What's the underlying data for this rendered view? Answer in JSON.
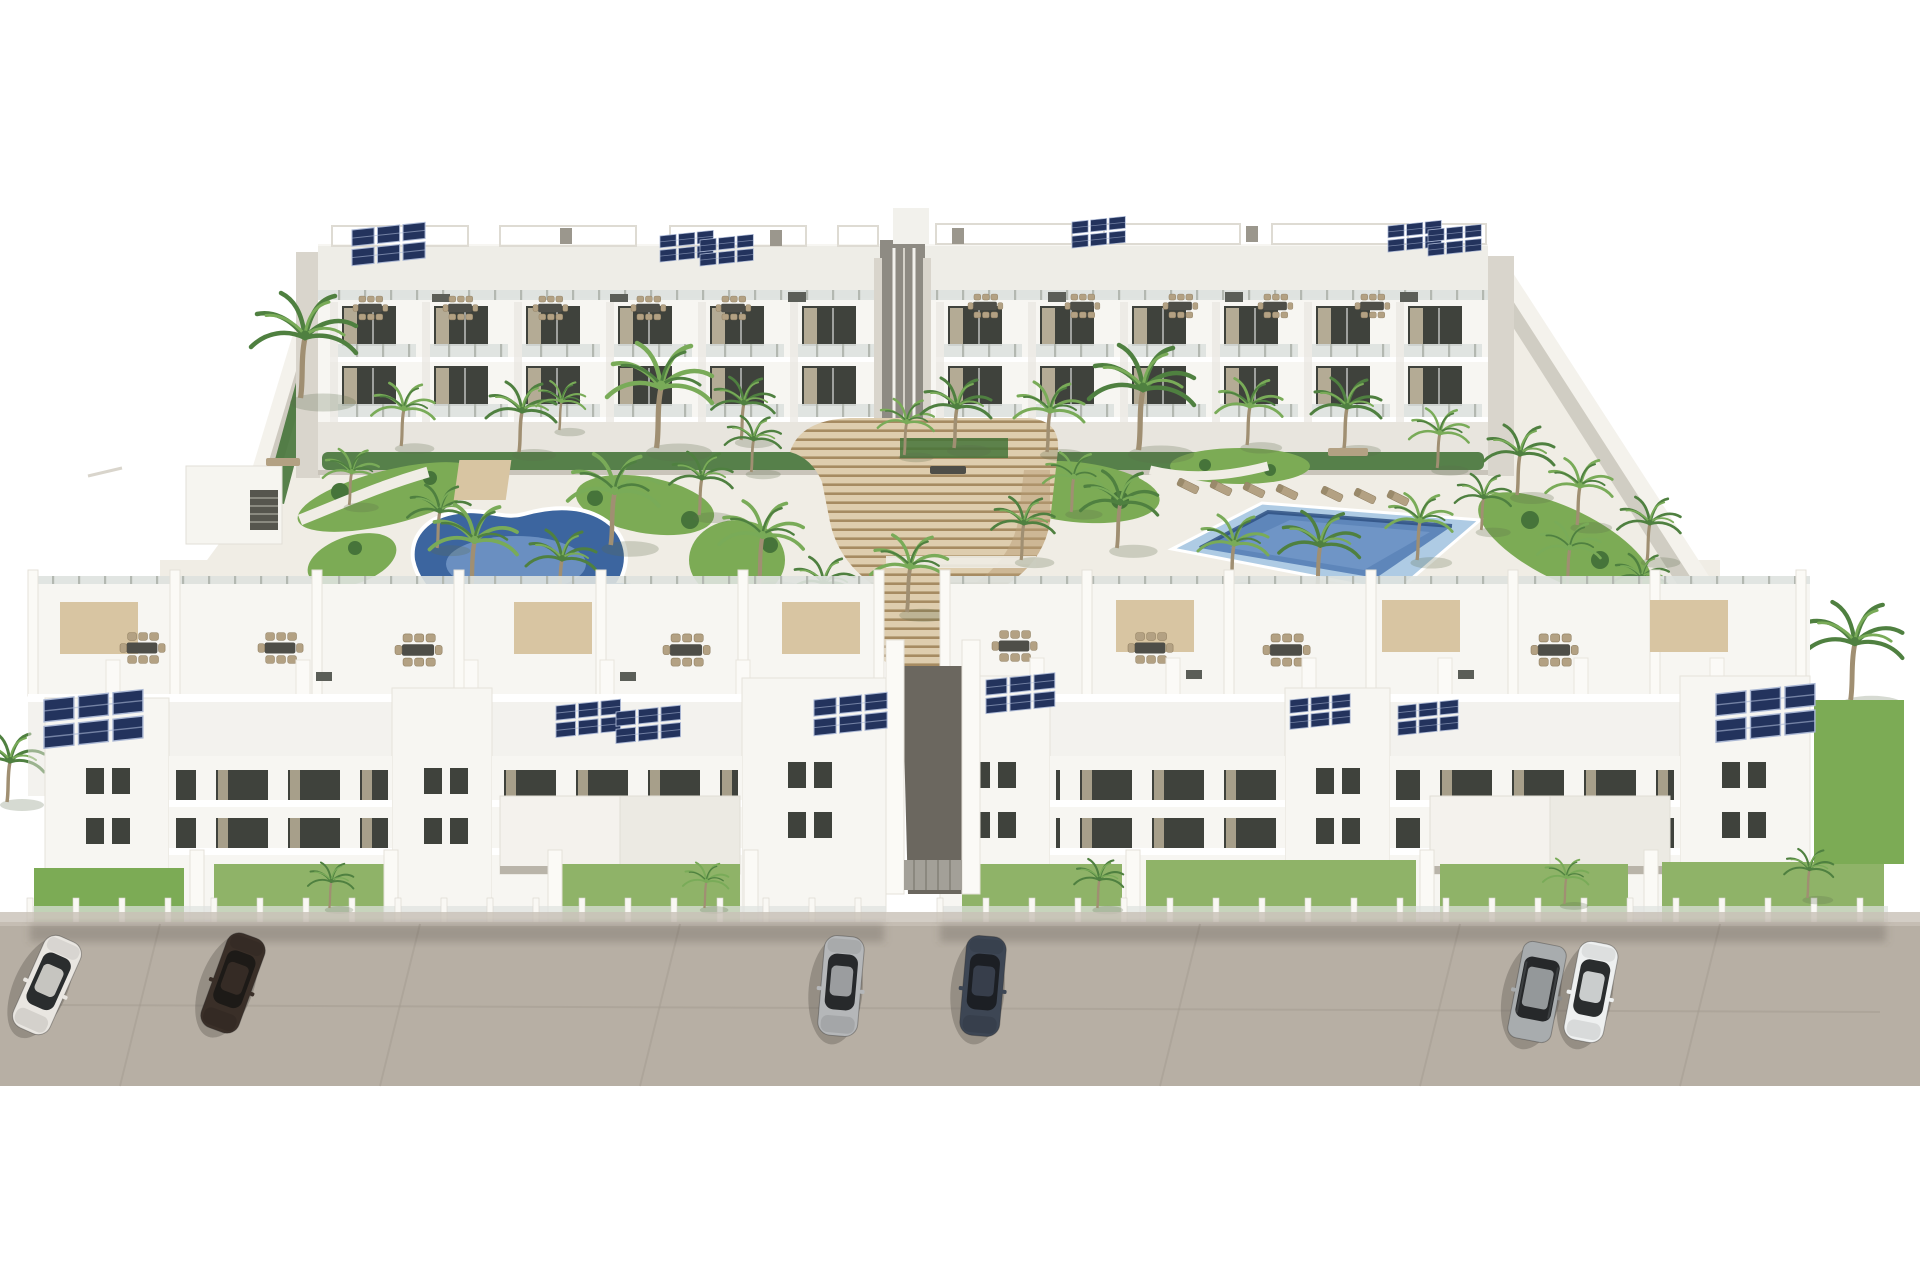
{
  "scene": {
    "kind": "aerial architectural render",
    "subject": "new-build white residential apartment complex with two communal pools, landscaped garden, central amphitheater staircase, rooftop solar panels and street parking",
    "sky": "plain white background",
    "time_of_day": "bright daylight"
  },
  "palette": {
    "building_white": "#f7f6f2",
    "building_shade": "#e8e5de",
    "building_side": "#d9d5cc",
    "deck_white": "#f0ede5",
    "wall_gray": "#c6c1b7",
    "window_dark": "#3f423c",
    "curtain": "#c9bda4",
    "rail_glass": "#dee3df",
    "rail_post": "#b3b8b1",
    "solar": "#23335d",
    "solar_line": "#aab7d4",
    "pergola_tan": "#d8c5a2",
    "pergola_line": "#dedbd3",
    "furn_tan": "#b3a183",
    "furn_dark": "#4e4e48",
    "stair_tread": "#decdae",
    "stair_riser": "#a68b62",
    "stair_side": "#b99d78",
    "grass_green": "#7cab55",
    "grass_bright": "#8fb368",
    "shrub_green": "#46743a",
    "palm_dark": "#4f8040",
    "palm_light": "#79ab58",
    "trunk": "#a08f72",
    "pool_ring": "#3c659f",
    "pool_water": "#5b8ac8",
    "pool_light": "#8fb2dc",
    "rpool_outer": "#aecbe4",
    "rpool_water": "#5e86ba",
    "rpool_edge": "#2f5183",
    "road_gray": "#b7afa4",
    "road_seam": "#a29a8f",
    "sidewalk": "#c8c1b6",
    "walk_dark": "#6b675f",
    "shadow": "#55504a"
  },
  "buildings": {
    "back_left": {
      "label": "rear apartment block west",
      "bays": {
        "start": 330,
        "count": 6,
        "step": 92,
        "rows": [
          302,
          362
        ]
      }
    },
    "back_right": {
      "label": "rear apartment block east",
      "bays": {
        "start": 936,
        "count": 6,
        "step": 92,
        "rows": [
          302,
          362
        ]
      }
    },
    "front_left": {
      "label": "street-front block west"
    },
    "front_right": {
      "label": "street-front block east"
    }
  },
  "objects": {
    "solar_arrays": [
      {
        "x": 352,
        "y": 230,
        "s": 0.85
      },
      {
        "x": 660,
        "y": 236,
        "s": 0.62
      },
      {
        "x": 700,
        "y": 240,
        "s": 0.62
      },
      {
        "x": 1072,
        "y": 222,
        "s": 0.62
      },
      {
        "x": 1388,
        "y": 226,
        "s": 0.62
      },
      {
        "x": 1428,
        "y": 230,
        "s": 0.62
      },
      {
        "x": 44,
        "y": 700,
        "s": 1.15
      },
      {
        "x": 556,
        "y": 706,
        "s": 0.75
      },
      {
        "x": 616,
        "y": 712,
        "s": 0.75
      },
      {
        "x": 814,
        "y": 700,
        "s": 0.85
      },
      {
        "x": 986,
        "y": 680,
        "s": 0.8
      },
      {
        "x": 1290,
        "y": 700,
        "s": 0.7
      },
      {
        "x": 1398,
        "y": 706,
        "s": 0.7
      },
      {
        "x": 1716,
        "y": 694,
        "s": 1.15
      }
    ],
    "roof_dining": [
      {
        "x": 370,
        "y": 308,
        "s": 0.85
      },
      {
        "x": 460,
        "y": 308,
        "s": 0.85
      },
      {
        "x": 550,
        "y": 308,
        "s": 0.85
      },
      {
        "x": 648,
        "y": 308,
        "s": 0.85
      },
      {
        "x": 733,
        "y": 308,
        "s": 0.85
      },
      {
        "x": 985,
        "y": 306,
        "s": 0.85
      },
      {
        "x": 1082,
        "y": 306,
        "s": 0.85
      },
      {
        "x": 1180,
        "y": 306,
        "s": 0.85
      },
      {
        "x": 1275,
        "y": 306,
        "s": 0.85
      },
      {
        "x": 1372,
        "y": 306,
        "s": 0.85
      }
    ],
    "terrace_dining": [
      {
        "x": 142,
        "y": 648,
        "s": 1.1
      },
      {
        "x": 280,
        "y": 648,
        "s": 1.1
      },
      {
        "x": 418,
        "y": 650,
        "s": 1.15
      },
      {
        "x": 686,
        "y": 650,
        "s": 1.15
      },
      {
        "x": 1014,
        "y": 646,
        "s": 1.1
      },
      {
        "x": 1150,
        "y": 648,
        "s": 1.1
      },
      {
        "x": 1286,
        "y": 650,
        "s": 1.15
      },
      {
        "x": 1554,
        "y": 650,
        "s": 1.15
      }
    ],
    "canopies": [
      {
        "x": 514,
        "y": 602
      },
      {
        "x": 782,
        "y": 602
      },
      {
        "x": 60,
        "y": 602
      },
      {
        "x": 1382,
        "y": 600
      },
      {
        "x": 1650,
        "y": 600
      },
      {
        "x": 1116,
        "y": 600
      }
    ],
    "palms": [
      {
        "x": 302,
        "y": 398,
        "s": 1.5,
        "t": "d"
      },
      {
        "x": 402,
        "y": 446,
        "s": 0.9,
        "t": "l"
      },
      {
        "x": 520,
        "y": 452,
        "s": 1.0,
        "t": "d"
      },
      {
        "x": 560,
        "y": 430,
        "s": 0.7,
        "t": "l"
      },
      {
        "x": 658,
        "y": 448,
        "s": 1.5,
        "t": "l"
      },
      {
        "x": 742,
        "y": 440,
        "s": 0.9,
        "t": "d"
      },
      {
        "x": 905,
        "y": 455,
        "s": 0.8,
        "t": "l"
      },
      {
        "x": 955,
        "y": 448,
        "s": 1.0,
        "t": "d"
      },
      {
        "x": 1048,
        "y": 452,
        "s": 1.0,
        "t": "l"
      },
      {
        "x": 1140,
        "y": 450,
        "s": 1.5,
        "t": "d"
      },
      {
        "x": 1248,
        "y": 445,
        "s": 0.95,
        "t": "l"
      },
      {
        "x": 1345,
        "y": 448,
        "s": 1.0,
        "t": "d"
      },
      {
        "x": 1438,
        "y": 468,
        "s": 0.85,
        "t": "l"
      },
      {
        "x": 1518,
        "y": 495,
        "s": 1.0,
        "t": "d"
      },
      {
        "x": 1578,
        "y": 525,
        "s": 0.95,
        "t": "l"
      },
      {
        "x": 1648,
        "y": 560,
        "s": 0.9,
        "t": "d"
      },
      {
        "x": 350,
        "y": 505,
        "s": 0.8,
        "t": "l"
      },
      {
        "x": 438,
        "y": 548,
        "s": 0.9,
        "t": "d"
      },
      {
        "x": 472,
        "y": 592,
        "s": 1.25,
        "t": "l"
      },
      {
        "x": 560,
        "y": 600,
        "s": 1.0,
        "t": "d"
      },
      {
        "x": 612,
        "y": 545,
        "s": 1.3,
        "t": "l"
      },
      {
        "x": 700,
        "y": 515,
        "s": 0.9,
        "t": "d"
      },
      {
        "x": 760,
        "y": 585,
        "s": 1.2,
        "t": "l"
      },
      {
        "x": 752,
        "y": 472,
        "s": 0.8,
        "t": "d"
      },
      {
        "x": 822,
        "y": 620,
        "s": 0.9,
        "t": "d"
      },
      {
        "x": 908,
        "y": 612,
        "s": 1.1,
        "t": "l"
      },
      {
        "x": 1022,
        "y": 560,
        "s": 0.9,
        "t": "d"
      },
      {
        "x": 1072,
        "y": 512,
        "s": 0.85,
        "t": "l"
      },
      {
        "x": 1118,
        "y": 548,
        "s": 1.1,
        "t": "d"
      },
      {
        "x": 1232,
        "y": 585,
        "s": 1.0,
        "t": "l"
      },
      {
        "x": 1318,
        "y": 592,
        "s": 1.15,
        "t": "d"
      },
      {
        "x": 1418,
        "y": 560,
        "s": 0.95,
        "t": "l"
      },
      {
        "x": 1482,
        "y": 530,
        "s": 0.8,
        "t": "d"
      },
      {
        "x": 1568,
        "y": 585,
        "s": 0.9,
        "t": "l"
      },
      {
        "x": 1640,
        "y": 610,
        "s": 0.8,
        "t": "d"
      },
      {
        "x": 1852,
        "y": 700,
        "s": 1.4,
        "t": "d"
      },
      {
        "x": 330,
        "y": 908,
        "s": 0.65,
        "t": "d"
      },
      {
        "x": 705,
        "y": 908,
        "s": 0.65,
        "t": "l"
      },
      {
        "x": 1098,
        "y": 908,
        "s": 0.7,
        "t": "d"
      },
      {
        "x": 1565,
        "y": 904,
        "s": 0.65,
        "t": "l"
      },
      {
        "x": 1808,
        "y": 898,
        "s": 0.7,
        "t": "d"
      },
      {
        "x": 8,
        "y": 802,
        "s": 1.0,
        "t": "d"
      }
    ],
    "loungers": [
      {
        "x": 1188,
        "y": 486,
        "r": -64
      },
      {
        "x": 1221,
        "y": 488,
        "r": -64
      },
      {
        "x": 1254,
        "y": 490,
        "r": -64
      },
      {
        "x": 1287,
        "y": 492,
        "r": -64
      },
      {
        "x": 1332,
        "y": 494,
        "r": -64
      },
      {
        "x": 1365,
        "y": 496,
        "r": -64
      },
      {
        "x": 1398,
        "y": 498,
        "r": -64
      },
      {
        "x": 408,
        "y": 622,
        "r": -58
      },
      {
        "x": 444,
        "y": 630,
        "r": -58
      },
      {
        "x": 640,
        "y": 606,
        "r": -62
      },
      {
        "x": 674,
        "y": 600,
        "r": -62
      }
    ],
    "benches": [
      {
        "x": 948,
        "y": 470,
        "w": 36,
        "tone": "dark"
      },
      {
        "x": 1348,
        "y": 452,
        "w": 40,
        "tone": "tan"
      },
      {
        "x": 283,
        "y": 462,
        "w": 34,
        "tone": "tan"
      }
    ],
    "cars": [
      {
        "label": "white sedan",
        "body": "#e9e6e1",
        "glass": "#2a2d2e",
        "x": 47,
        "y": 985,
        "rot": 24,
        "type": "sedan"
      },
      {
        "label": "dark brown sedan",
        "body": "#3a2f28",
        "glass": "#1d1a17",
        "x": 233,
        "y": 983,
        "rot": 20,
        "type": "sedan"
      },
      {
        "label": "silver sedan",
        "body": "#b5b7b9",
        "glass": "#27292b",
        "x": 841,
        "y": 986,
        "rot": 5,
        "type": "sedan"
      },
      {
        "label": "dark blue sedan",
        "body": "#3d4654",
        "glass": "#1c1f24",
        "x": 983,
        "y": 986,
        "rot": 5,
        "type": "sedan"
      },
      {
        "label": "silver suv",
        "body": "#a8acae",
        "glass": "#26282a",
        "x": 1537,
        "y": 992,
        "rot": 11,
        "type": "suv"
      },
      {
        "label": "white sedan",
        "body": "#eef0f0",
        "glass": "#2a2d2e",
        "x": 1591,
        "y": 992,
        "rot": 11,
        "type": "sedan"
      }
    ],
    "fences": [
      {
        "x1": 30,
        "x2": 884,
        "y": 934
      },
      {
        "x1": 940,
        "x2": 1886,
        "y": 934
      }
    ],
    "lawns": [
      {
        "x": 34,
        "y": 868,
        "w": 150,
        "h": 60,
        "f": "lawn1"
      },
      {
        "x": 214,
        "y": 864,
        "w": 170,
        "h": 66,
        "f": "lawn2"
      },
      {
        "x": 562,
        "y": 864,
        "w": 178,
        "h": 66,
        "f": "lawn2"
      },
      {
        "x": 962,
        "y": 864,
        "w": 160,
        "h": 66,
        "f": "lawn2"
      },
      {
        "x": 1146,
        "y": 860,
        "w": 270,
        "h": 70,
        "f": "lawn2"
      },
      {
        "x": 1440,
        "y": 864,
        "w": 188,
        "h": 66,
        "f": "lawn2"
      },
      {
        "x": 1662,
        "y": 862,
        "w": 222,
        "h": 68,
        "f": "lawn2"
      },
      {
        "x": 1814,
        "y": 700,
        "w": 90,
        "h": 164,
        "f": "lawn1"
      }
    ]
  }
}
